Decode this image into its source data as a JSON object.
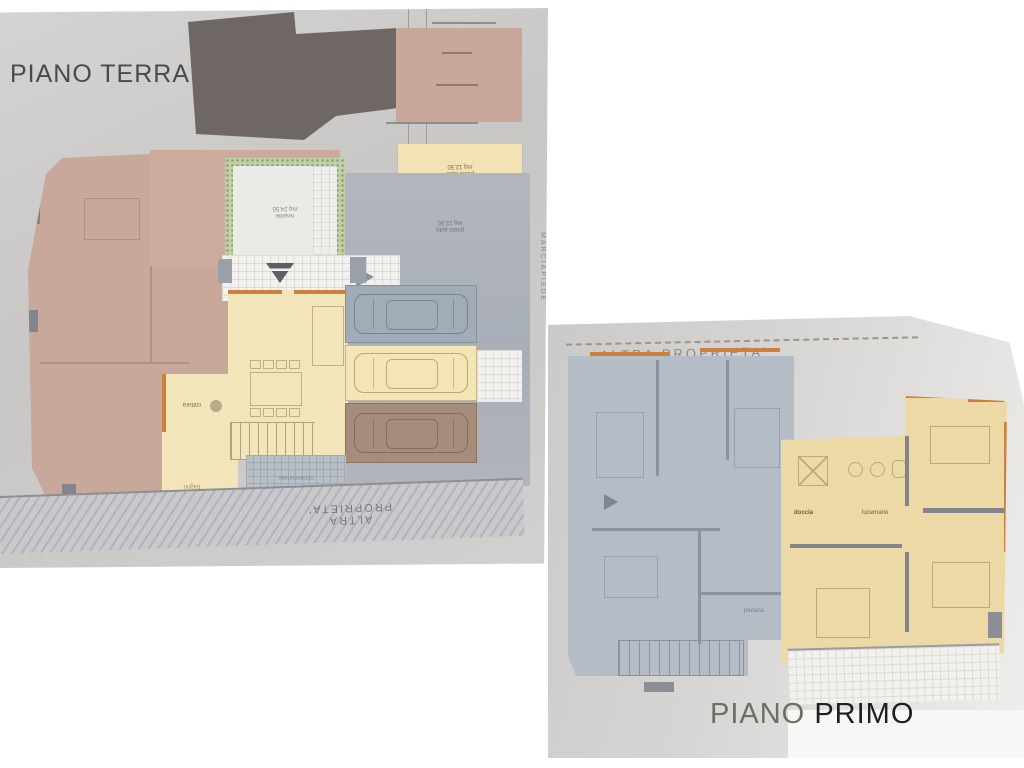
{
  "page_background": "#ffffff",
  "ground_floor": {
    "title": "PIANO TERRA",
    "labels": {
      "parking_highlight_line1": "posto auto",
      "parking_highlight_line2": "mq 12,50",
      "parking_other_line1": "posto auto",
      "parking_other_line2": "mq 12,50",
      "courtyard_line1": "resede",
      "courtyard_line2": "mq 24,50",
      "kitchen": "cottura",
      "bathroom": "bagno",
      "condo_area": "condominiale",
      "technical_room": "loc. tec.",
      "other_property": "ALTRA PROPRIETA'",
      "sidewalk": "MARCIAPIEDE"
    }
  },
  "first_floor": {
    "title_word1": "PIANO",
    "title_word2": "PRIMO",
    "labels": {
      "other_property": "ALTRA PROPRIETA'",
      "shower": "doccia",
      "skylight": "lucernario",
      "platform": "pedana"
    }
  },
  "colors": {
    "highlight_unit_yellow": "#f2e3b4",
    "other_unit_pink": "#c7a89a",
    "other_unit_blue": "#b4bdc6",
    "garage_brown": "#a68c7a",
    "adjacent_building_dark": "#6f6763",
    "plan_paper_gray": "#cccbc9",
    "wall_orange": "#cd7f3c",
    "hedge_green": "#c3cfa9"
  }
}
